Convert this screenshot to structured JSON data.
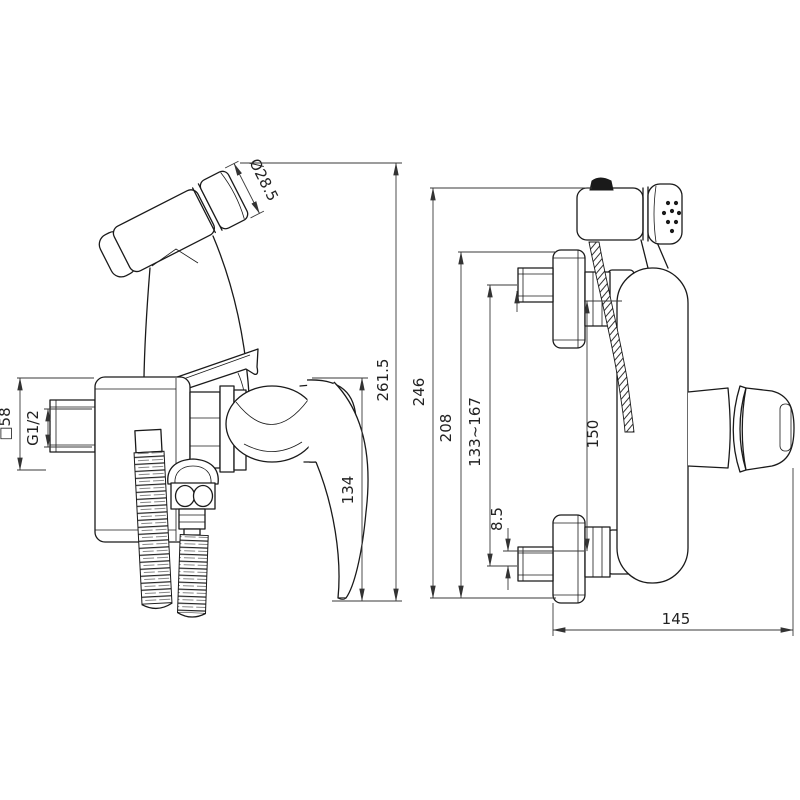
{
  "drawing": {
    "type": "technical-dimension-drawing",
    "subject": "wall-mounted bidet mixer with hand sprayer, two orthographic views",
    "colors": {
      "bg": "#ffffff",
      "obj": "#1a1a1a",
      "dim": "#3a3a3a",
      "txt": "#222222"
    },
    "views": {
      "side": {
        "dims": {
          "head_diameter": "Ø28.5",
          "flange_square": "□58",
          "inlet_thread": "G1/2",
          "overall_height": "261.5",
          "handle_height": "134"
        }
      },
      "front": {
        "dims": {
          "overall_height": "246",
          "bracket_height": "208",
          "inlet_span": "133~167",
          "eccentric_offset": "8.5",
          "nut_span": "150",
          "depth": "145"
        }
      }
    }
  }
}
